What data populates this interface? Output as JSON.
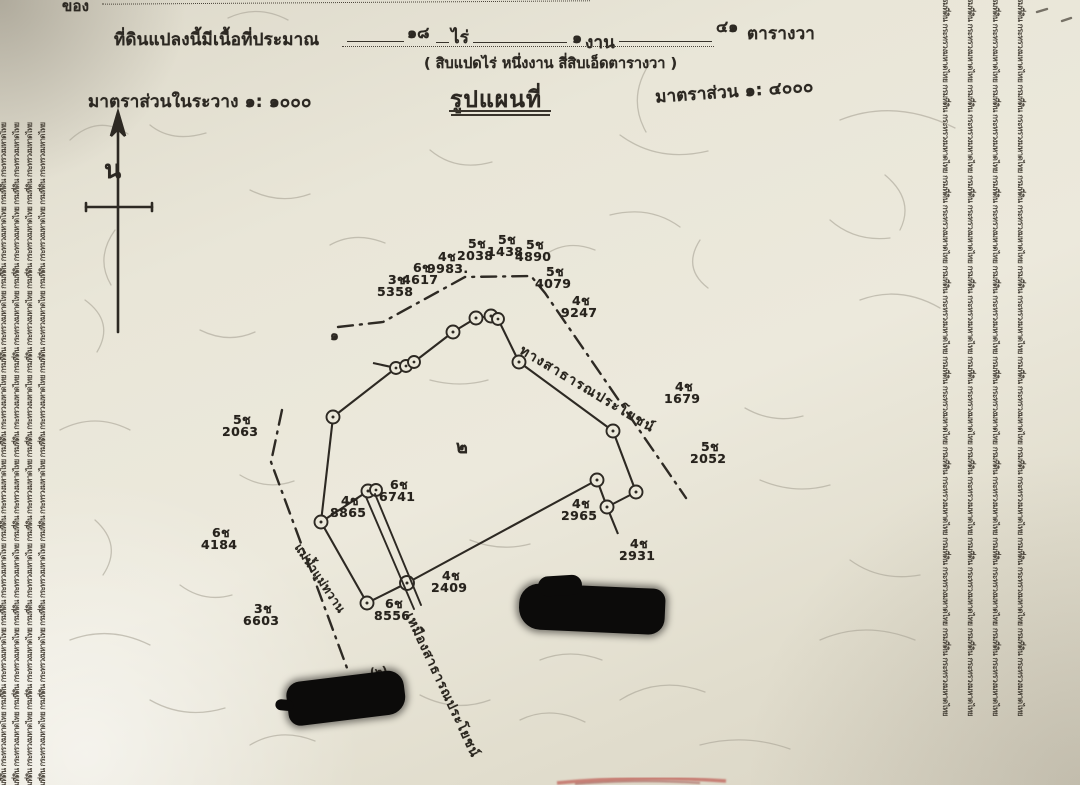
{
  "document": {
    "corner_label": "ของ",
    "area_line": {
      "prefix": "ที่ดินแปลงนี้มีเนื้อที่ประมาณ",
      "rai_value": "๑๘",
      "rai_unit": "ไร่",
      "ngan_value": "๑",
      "ngan_unit": "งาน",
      "wa_value": "๔๑",
      "wa_unit": "ตารางวา",
      "spelled_out": "( สิบแปดไร่ หนึ่งงาน สี่สิบเอ็ดตารางวา )"
    },
    "scale_in_sheet": "มาตราส่วนในระวาง  ๑:  ๑๐๐๐",
    "map_title": "รูปแผนที่",
    "scale_right": "มาตราส่วน  ๑:  ๔๐๐๐",
    "north_label": "น"
  },
  "watermark": {
    "phrase": "กรมที่ดิน กระทรวงมหาดไทย",
    "column_text": "กรมที่ดิน กระทรวงมหาดไทย กรมที่ดิน กระทรวงมหาดไทย กรมที่ดิน กระทรวงมหาดไทย กรมที่ดิน กระทรวงมหาดไทย กรมที่ดิน กระทรวงมหาดไทย กรมที่ดิน กระทรวงมหาดไทย กรมที่ดิน กระทรวงมหาดไทย กรมที่ดิน กระทรวงมหาดไทย"
  },
  "map": {
    "road_label": "ทางสาธารณประโยชน์",
    "ditch_label": "เหมืองสาธารณประโยชน์",
    "river_label": "แม่น้ำแม่ทวาน",
    "parcel_number": "๒",
    "adjacent_mark": "๑",
    "redaction_note": "(๒)",
    "markers": [
      {
        "prefix": "3ช",
        "number": "5358"
      },
      {
        "prefix": "6ช",
        "number": "4617"
      },
      {
        "prefix": "4ช",
        "number": "9983."
      },
      {
        "prefix": "5ช",
        "number": "2038"
      },
      {
        "prefix": "5ช",
        "number": "1438"
      },
      {
        "prefix": "5ช",
        "number": "4890"
      },
      {
        "prefix": "5ช",
        "number": "4079"
      },
      {
        "prefix": "4ช",
        "number": "9247"
      },
      {
        "prefix": "4ช",
        "number": "1679"
      },
      {
        "prefix": "5ช",
        "number": "2052"
      },
      {
        "prefix": "4ช",
        "number": "2965"
      },
      {
        "prefix": "4ช",
        "number": "2931"
      },
      {
        "prefix": "4ช",
        "number": "2409"
      },
      {
        "prefix": "6ช",
        "number": "8556"
      },
      {
        "prefix": "6ช",
        "number": "6741"
      },
      {
        "prefix": "4ช",
        "number": "8865"
      },
      {
        "prefix": "5ช",
        "number": "2063"
      },
      {
        "prefix": "6ช",
        "number": "4184"
      },
      {
        "prefix": "3ช",
        "number": "6603"
      }
    ]
  }
}
